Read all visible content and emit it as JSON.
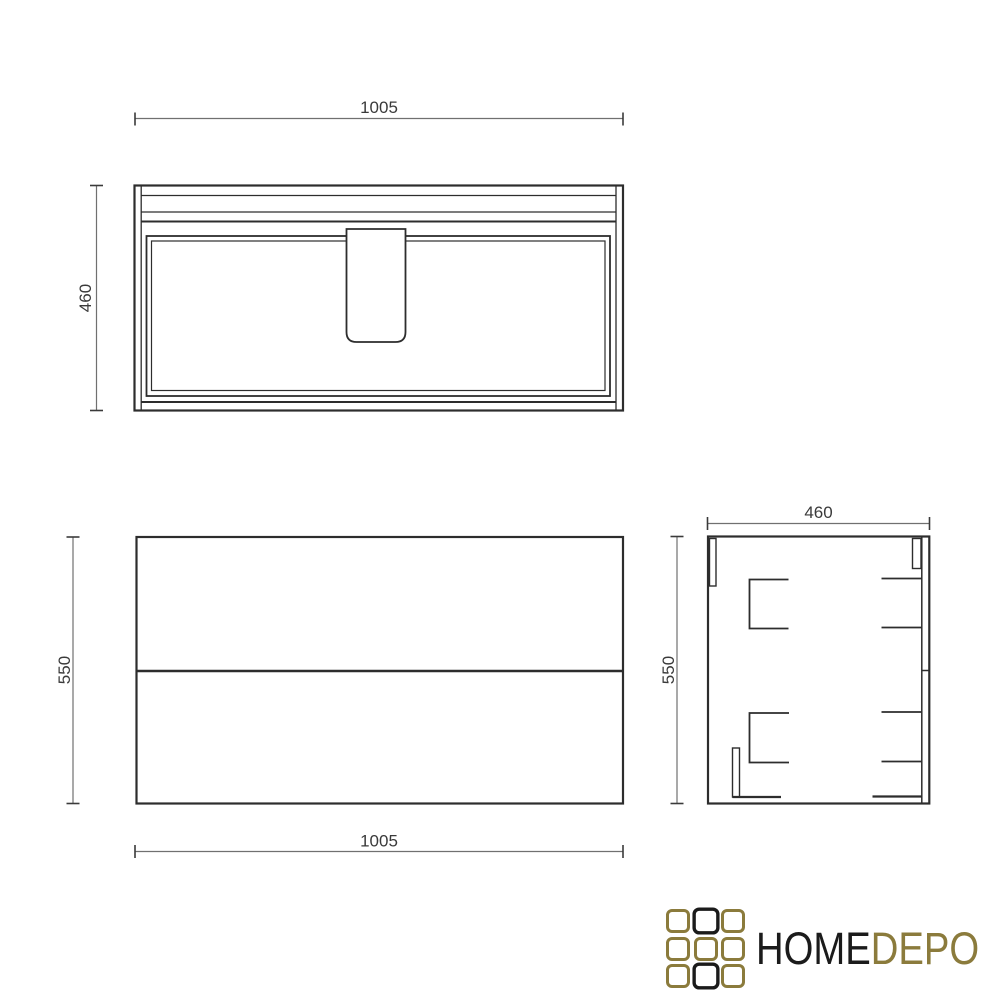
{
  "page": {
    "background": "#ffffff"
  },
  "drawing": {
    "line_color": "#2d2d2d",
    "dim_line_color": "#707070",
    "dim_text_color": "#3a3a3a",
    "views": {
      "top": {
        "width_label": "1005",
        "depth_label": "460"
      },
      "front": {
        "width_label": "1005",
        "height_label": "550"
      },
      "side": {
        "depth_label": "460",
        "height_label": "550"
      }
    }
  },
  "logo": {
    "text_primary": "HOME",
    "text_secondary": "DEPO",
    "primary_color": "#1b1b1b",
    "accent_color": "#8b7b3c",
    "grid_cells": [
      "gold",
      "black",
      "gold",
      "gold",
      "gold",
      "gold",
      "gold",
      "black",
      "gold"
    ]
  }
}
